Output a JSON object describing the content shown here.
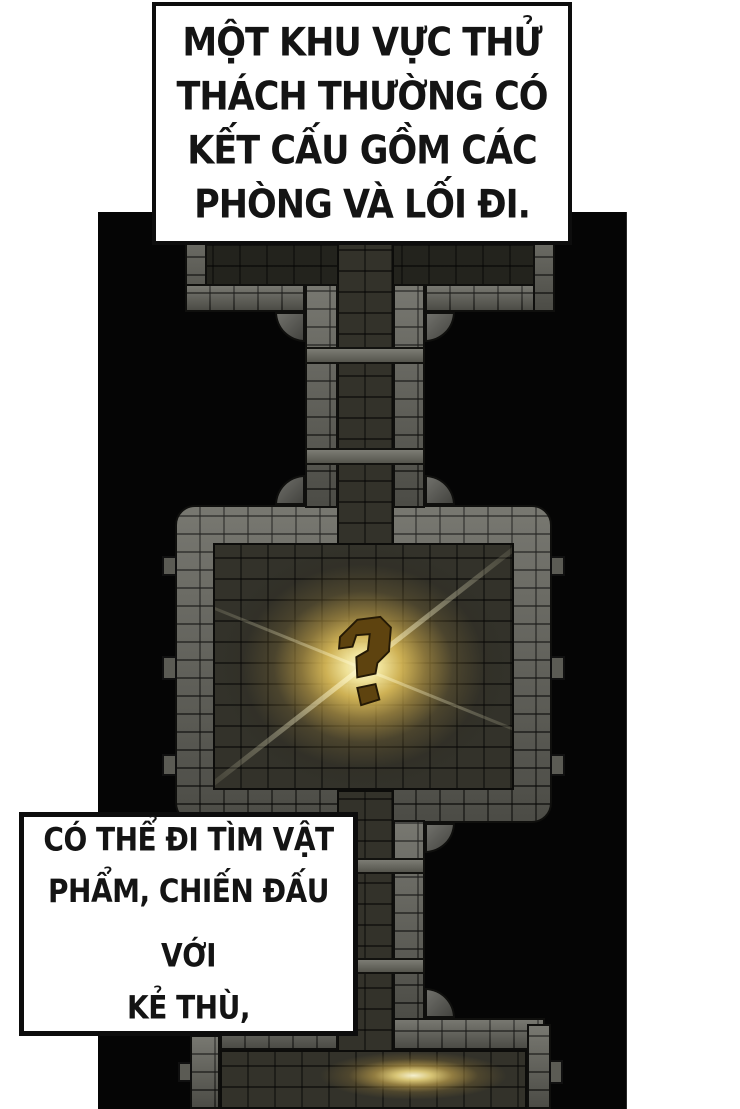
{
  "page": {
    "type": "manhwa-panel",
    "background": "#ffffff"
  },
  "captions": {
    "top": {
      "lines": [
        "MỘT KHU VỰC THỬ",
        "THÁCH THƯỜNG CÓ",
        "KẾT CẤU GỒM CÁC",
        "PHÒNG VÀ LỐI ĐI."
      ]
    },
    "bottom": {
      "lines": [
        "CÓ THỂ ĐI TÌM VẬT",
        "PHẨM, CHIẾN ĐẤU VỚI",
        "KẺ THÙ,"
      ]
    }
  },
  "map": {
    "description": "top-down dungeon trial-zone map with rooms and corridors",
    "marker": {
      "icon": "question-mark",
      "glyph": "?",
      "color": "#5e430f"
    },
    "colors": {
      "panel": "#050505",
      "wall": "#65655d",
      "floor": "#33322a",
      "floor_dim": "#23231d",
      "glow_core": "#fffce2",
      "glow_gold": "#e9c75c",
      "outline": "#0f0f0d"
    }
  }
}
